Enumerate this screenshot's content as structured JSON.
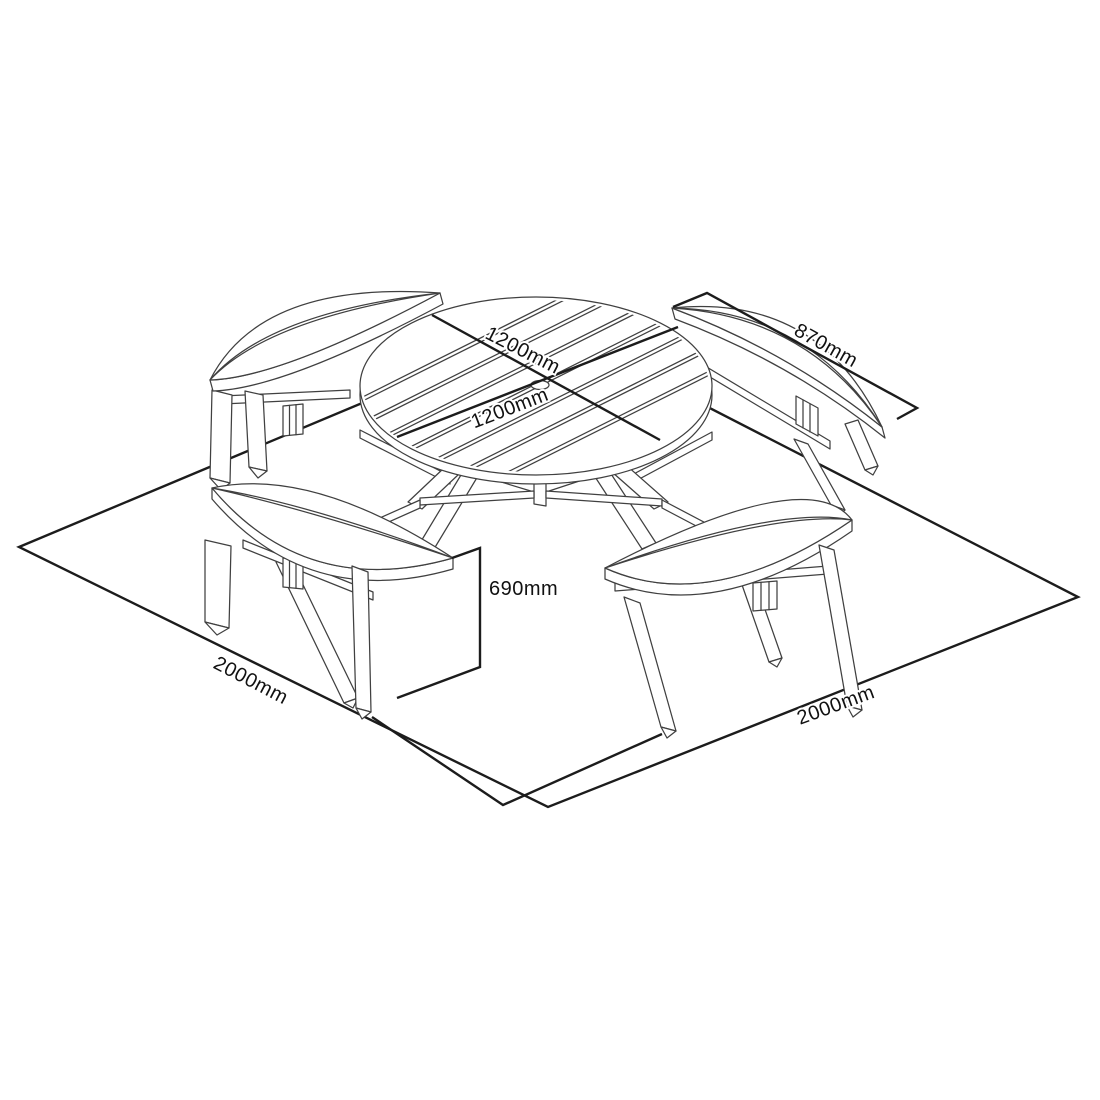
{
  "page": {
    "background": "#ffffff",
    "line_color": "#404040",
    "dimension_color": "#1c1c1c"
  },
  "diagram": {
    "kind": "isometric dimension line drawing",
    "subject": "round picnic table with four curved benches on a square footprint",
    "dimensions": {
      "table_diameter_1": "1200mm",
      "table_diameter_2": "1200mm",
      "bench_length": "870mm",
      "seat_height": "690mm",
      "footprint_left": "2000mm",
      "footprint_right": "2000mm"
    }
  }
}
